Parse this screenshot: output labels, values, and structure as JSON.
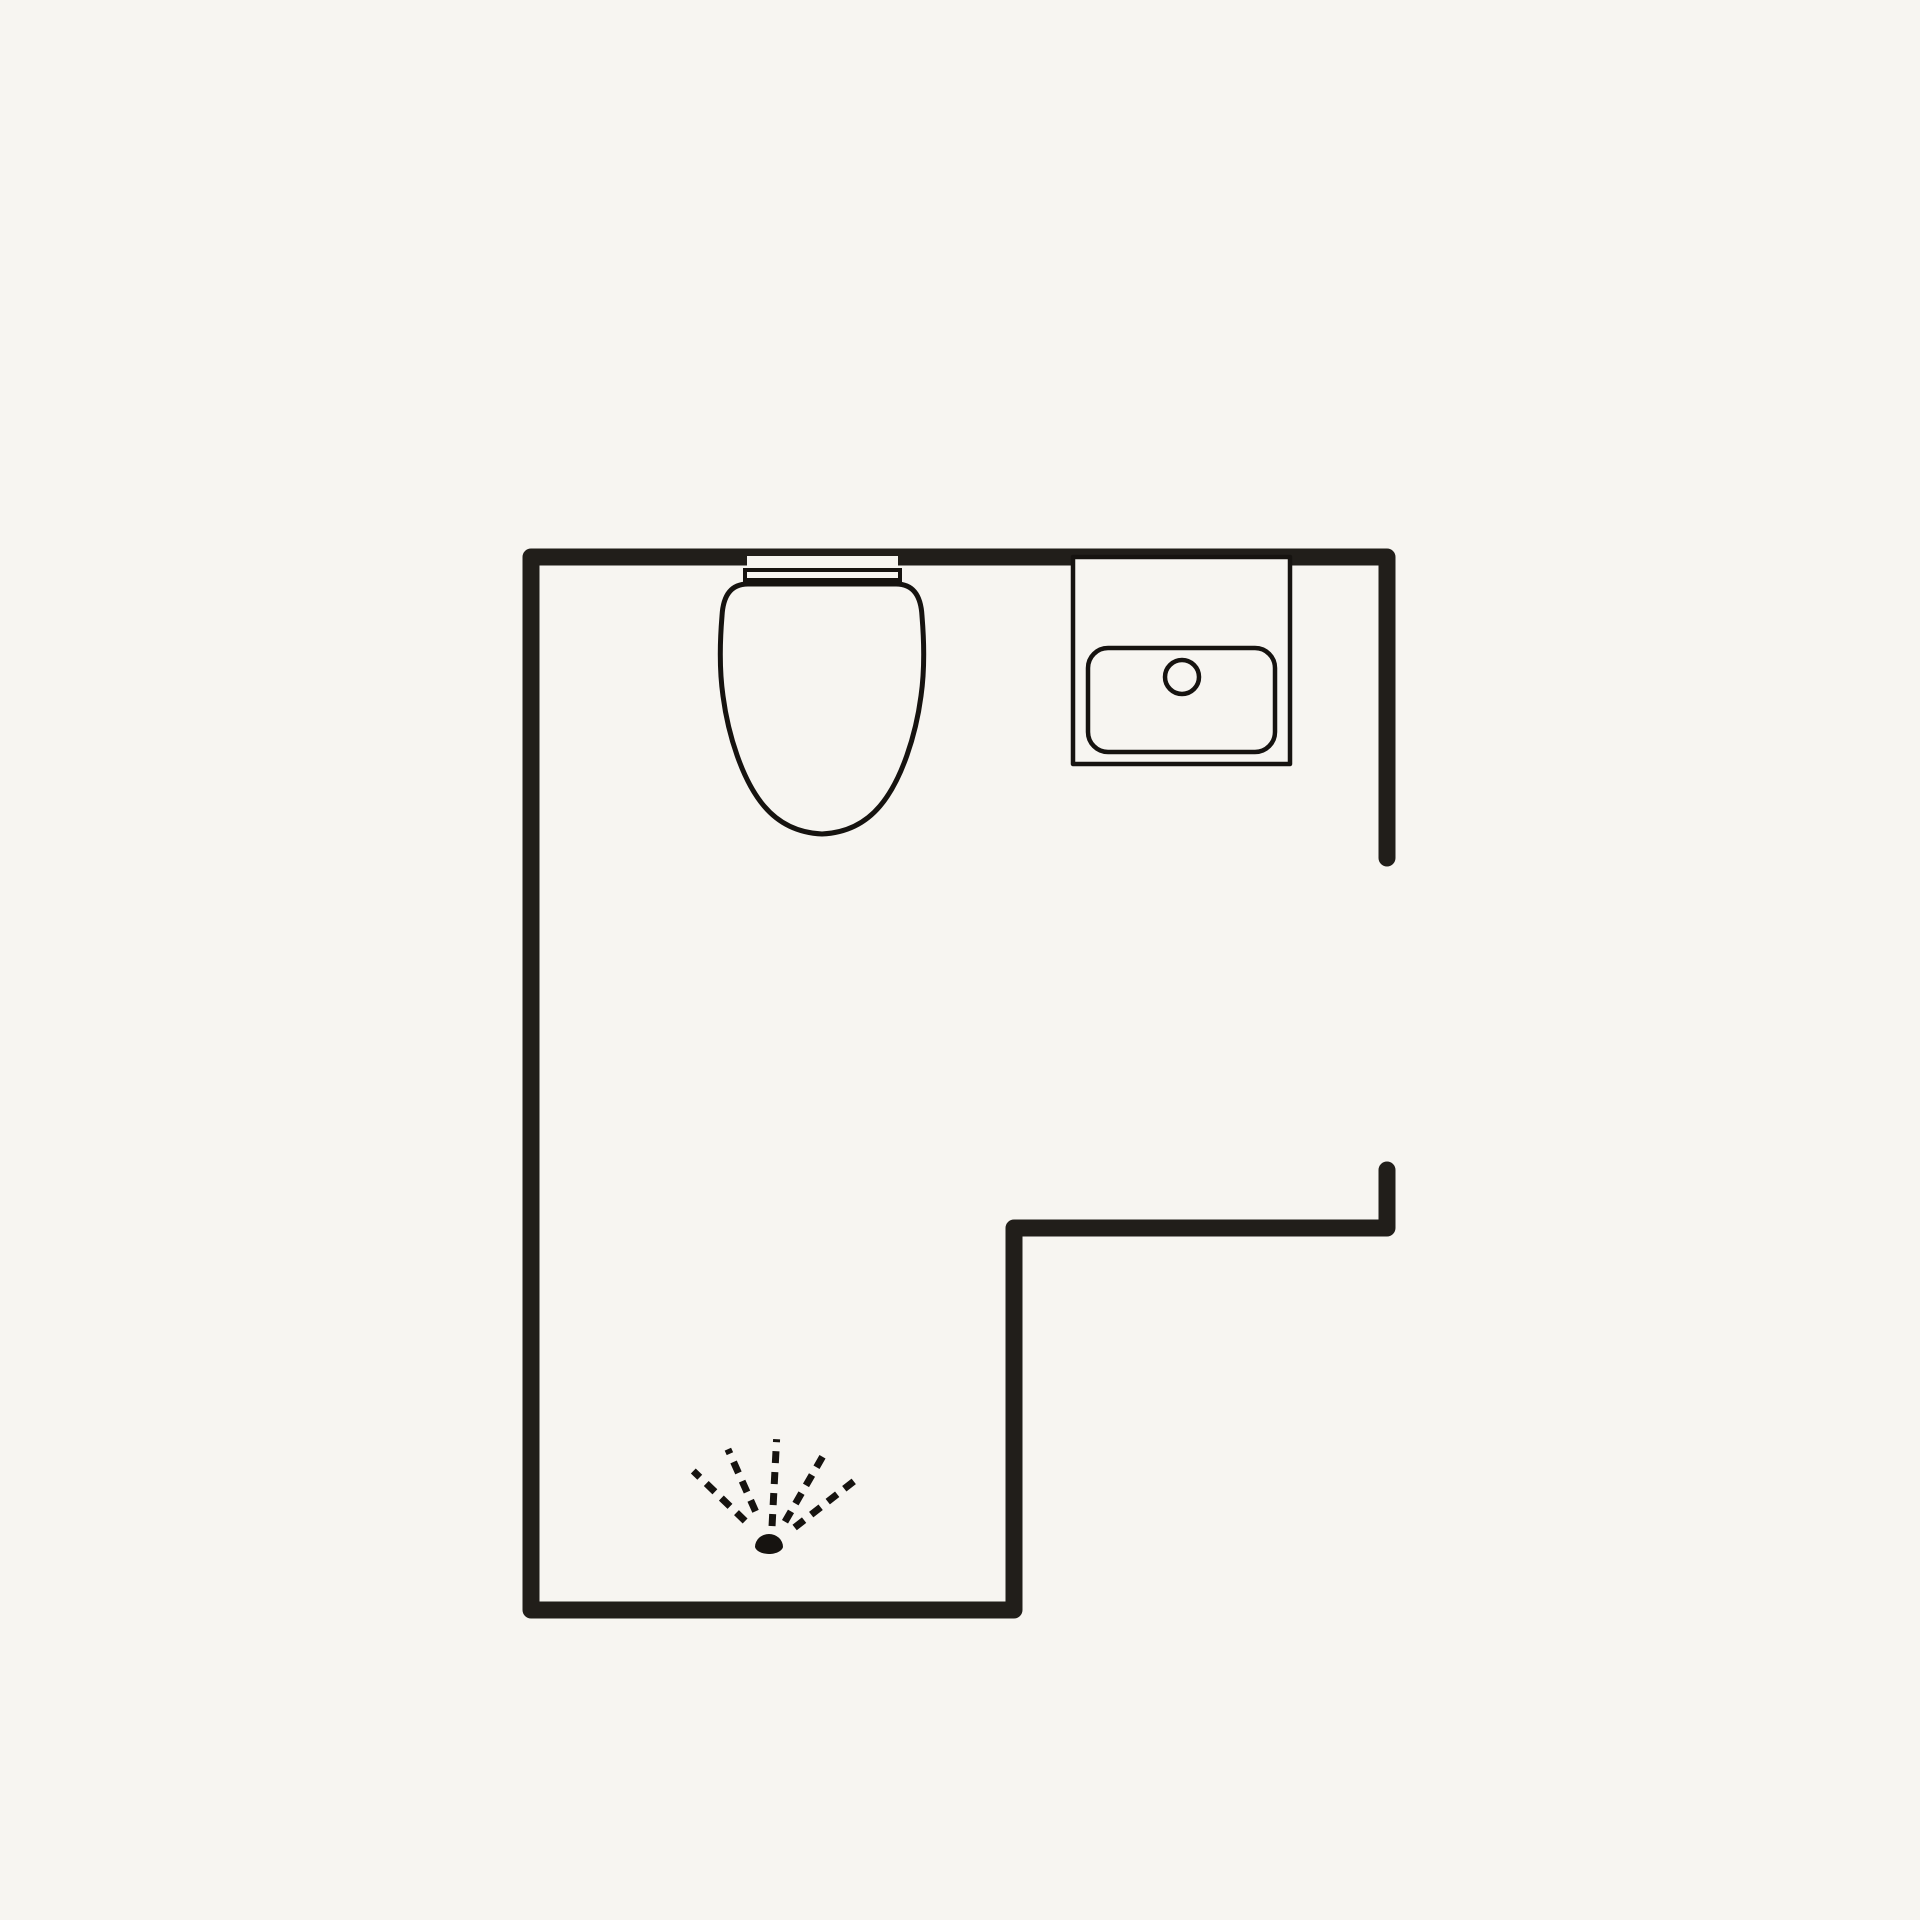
{
  "title": "Bathroom floor plan",
  "canvas": {
    "width": 1920,
    "height": 1920,
    "background": "#f7f5f1"
  },
  "plan": {
    "wall": {
      "color": "#211e1a",
      "thickness": 17
    },
    "fixture": {
      "stroke": "#161310",
      "fill": "#f7f5f1"
    },
    "wall_segments": [
      {
        "name": "room-outline-wall",
        "points": [
          [
            1387,
            858
          ],
          [
            1387,
            557
          ],
          [
            531,
            557
          ],
          [
            531,
            1610
          ],
          [
            1014,
            1610
          ],
          [
            1014,
            1228
          ],
          [
            1387,
            1228
          ],
          [
            1387,
            1170
          ]
        ]
      }
    ],
    "door_opening": {
      "side": "right",
      "y_top": 858,
      "y_bottom": 1170
    },
    "toilet": {
      "notch": {
        "x": 747,
        "y": 556,
        "w": 151,
        "h": 12
      },
      "tank": {
        "x": 745,
        "y": 570,
        "w": 155,
        "h": 10,
        "stroke_width": 4
      },
      "bowl": {
        "stroke_width": 5,
        "path": "M 748 584 C 730 584 723 597 722 616 C 720 640 719 668 723 696 C 728 734 742 780 764 806 C 780 825 800 833 822 834 C 844 833 864 825 880 806 C 902 780 916 734 921 696 C 925 668 924 640 922 616 C 921 597 914 584 896 584 Z"
      }
    },
    "sink": {
      "counter": {
        "x": 1073,
        "y": 557,
        "w": 217,
        "h": 207,
        "stroke_width": 4.5
      },
      "basin": {
        "x": 1088,
        "y": 648,
        "w": 187,
        "h": 104,
        "rx": 20,
        "stroke_width": 4.5
      },
      "drain": {
        "cx": 1182,
        "cy": 677,
        "r": 17,
        "stroke_width": 4.5
      }
    },
    "shower": {
      "cx": 771,
      "cy": 1546,
      "nozzle_path": "M 755 1547 A 14 13 0 0 1 783 1547 C 782 1551 776 1554 769 1554 C 762 1554 756 1551 755 1547 Z",
      "ray_style": {
        "width": 7,
        "dash": "12 9"
      },
      "rays": [
        {
          "angle_deg": 136,
          "r0": 36,
          "r1": 108
        },
        {
          "angle_deg": 114,
          "r0": 38,
          "r1": 106
        },
        {
          "angle_deg": 87,
          "r0": 20,
          "r1": 107
        },
        {
          "angle_deg": 60,
          "r0": 28,
          "r1": 108
        },
        {
          "angle_deg": 38,
          "r0": 30,
          "r1": 110
        }
      ]
    }
  }
}
